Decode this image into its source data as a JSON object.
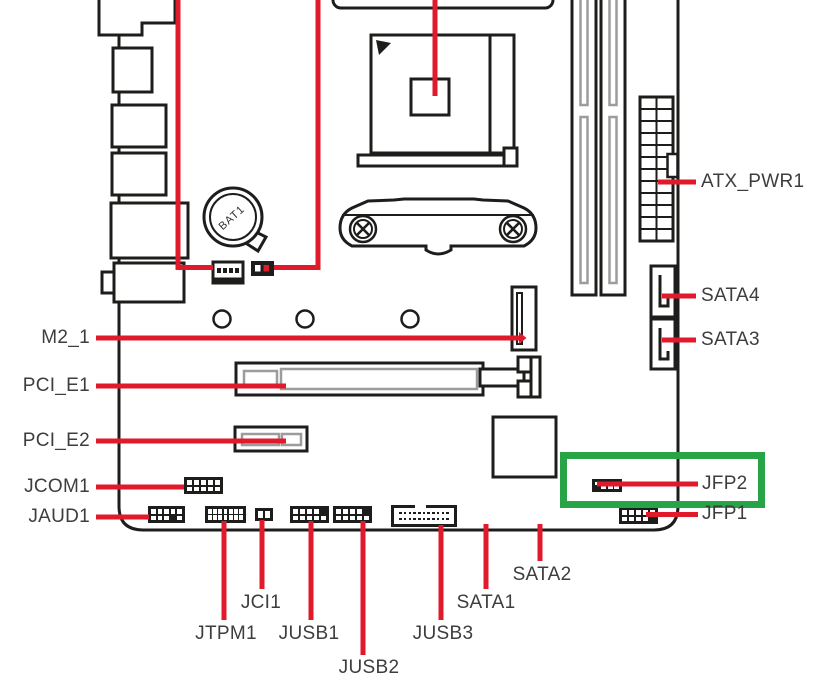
{
  "figure": {
    "type": "motherboard-connector-location-diagram",
    "highlight": {
      "target": "JFP2",
      "box_color": "#26a446"
    },
    "colors": {
      "callout": "#e01a2b",
      "outline": "#1d1d1b",
      "text": "#3d3d3f",
      "slot_inner": "#9c9c9c"
    },
    "battery": {
      "label": "BAT1"
    },
    "callouts": {
      "left": [
        {
          "id": "m2_1",
          "label": "M2_1"
        },
        {
          "id": "pci_e1",
          "label": "PCI_E1"
        },
        {
          "id": "pci_e2",
          "label": "PCI_E2"
        },
        {
          "id": "jcom1",
          "label": "JCOM1"
        },
        {
          "id": "jaud1",
          "label": "JAUD1"
        }
      ],
      "right": [
        {
          "id": "atx_pwr1",
          "label": "ATX_PWR1"
        },
        {
          "id": "sata4",
          "label": "SATA4"
        },
        {
          "id": "sata3",
          "label": "SATA3"
        },
        {
          "id": "jfp2",
          "label": "JFP2"
        },
        {
          "id": "jfp1",
          "label": "JFP1"
        }
      ],
      "bottom": [
        {
          "id": "jtpm1",
          "label": "JTPM1"
        },
        {
          "id": "jci1",
          "label": "JCI1"
        },
        {
          "id": "jusb1",
          "label": "JUSB1"
        },
        {
          "id": "jusb2",
          "label": "JUSB2"
        },
        {
          "id": "jusb3",
          "label": "JUSB3"
        },
        {
          "id": "sata1",
          "label": "SATA1"
        },
        {
          "id": "sata2",
          "label": "SATA2"
        }
      ]
    }
  }
}
